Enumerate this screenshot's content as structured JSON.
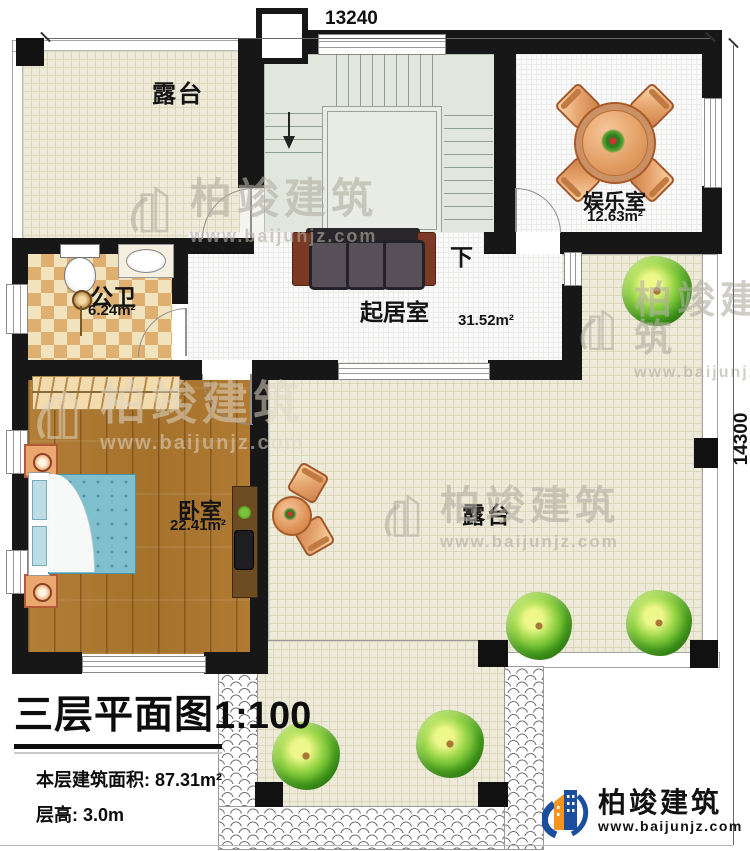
{
  "dimensions": {
    "top": "13240",
    "right": "14300"
  },
  "rooms": {
    "terrace_top": {
      "name": "露台"
    },
    "entertainment": {
      "name": "娱乐室",
      "area": "12.63m²"
    },
    "bathroom": {
      "name": "公卫",
      "area": "6.24m²"
    },
    "living": {
      "name": "起居室",
      "area": "31.52m²"
    },
    "bedroom": {
      "name": "卧室",
      "area": "22.41m²"
    },
    "terrace_right": {
      "name": "露台"
    }
  },
  "stairs": {
    "down_label": "下"
  },
  "title_block": {
    "title": "三层平面图",
    "scale": "1:100",
    "area_line": "本层建筑面积: 87.31m²",
    "floor_height_line": "层高: 3.0m"
  },
  "brand": {
    "name": "柏竣建筑",
    "url": "www.baijunjz.com"
  },
  "watermark": {
    "name": "柏竣建筑",
    "url": "www.baijunjz.com"
  },
  "colors": {
    "wall": "#171717",
    "terrace_floor": "#edeada",
    "wood_floor": "#a9752f",
    "stair_floor": "#e2e7de",
    "brand_blue": "#1b4f9e",
    "brand_orange": "#f7941d"
  }
}
